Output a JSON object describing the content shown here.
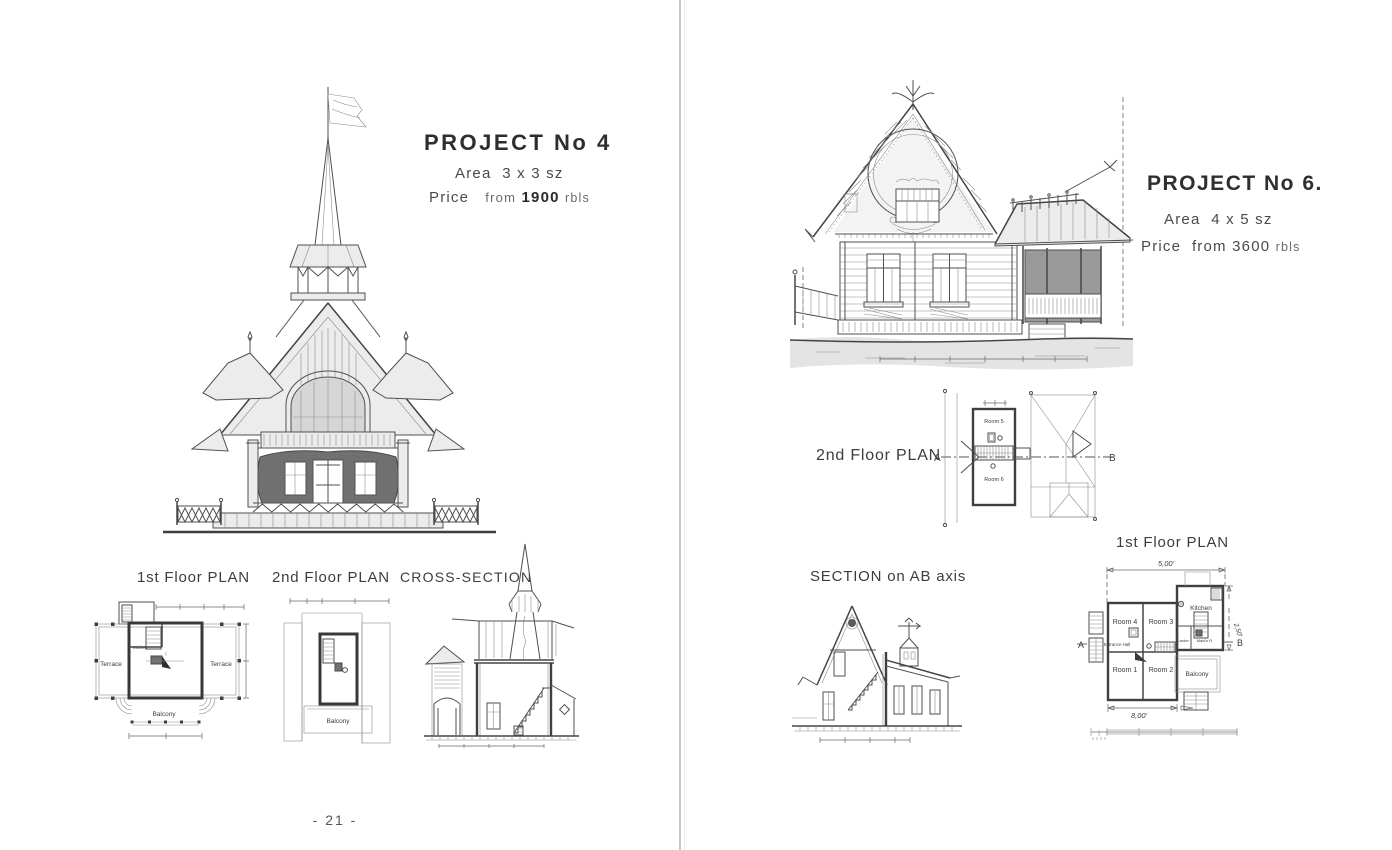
{
  "colors": {
    "paper": "#ffffff",
    "ink": "#3a3a3a",
    "divider": "#c7c7c7"
  },
  "page_number": "- 21 -",
  "left_page": {
    "title": "PROJECT  No 4",
    "area": {
      "label": "Area",
      "value": "3 x 3 sz"
    },
    "price": {
      "label": "Price",
      "from": "from",
      "value": "1900",
      "unit": "rbls"
    },
    "captions": {
      "first_floor": "1st Floor PLAN",
      "second_floor": "2nd Floor PLAN",
      "cross_section": "CROSS-SECTION"
    },
    "first_floor_labels": {
      "terrace_left": "Terrace",
      "kitchen": "Kitchen",
      "terrace_right": "Terrace",
      "balcony": "Balcony"
    },
    "second_floor_labels": {
      "balcony": "Balcony"
    }
  },
  "right_page": {
    "title": "PROJECT No 6.",
    "area": {
      "label": "Area",
      "value": "4 x 5 sz"
    },
    "price": {
      "label": "Price",
      "from": "from",
      "value": "3600",
      "unit": "rbls"
    },
    "captions": {
      "second_floor": "2nd Floor PLAN",
      "section": "SECTION on AB axis",
      "first_floor": "1st Floor PLAN"
    },
    "second_floor_labels": {
      "room5": "Room 5",
      "room6": "Room 6",
      "axis_a": "A",
      "axis_b": "B"
    },
    "first_floor_labels": {
      "room4": "Room 4",
      "room3": "Room 3",
      "kitchen": "Kitchen",
      "entrance_hall": "Entrance Hall",
      "larder": "Larder",
      "maids_room": "Maid's R.",
      "room1": "Room 1",
      "room2": "Room 2",
      "balcony": "Balcony",
      "axis_a": "A",
      "axis_b": "B",
      "dim_top": "5,00'",
      "dim_right": "2,50'",
      "dim_bottom": "8,00'"
    }
  }
}
